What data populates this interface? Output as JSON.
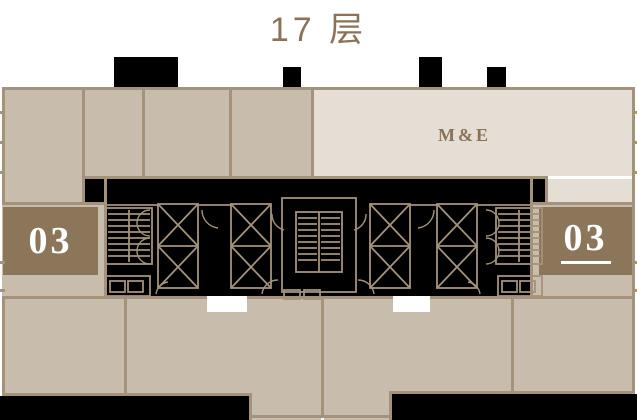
{
  "title": "17 层",
  "floor_plan": {
    "me_room_label": "M&E",
    "units": [
      {
        "id": "unit-03-left",
        "label": "03",
        "selected": false
      },
      {
        "id": "unit-03-right",
        "label": "03",
        "selected": true
      }
    ],
    "icons": [
      "elevator-icon",
      "staircase-icon",
      "door-swing-icon",
      "wc-fixture-icon"
    ],
    "colors": {
      "room_beige": "#c8bdad",
      "me_light": "#e4ded4",
      "wall_tan": "#a4927a",
      "unit_brown": "#8b765a",
      "core_black": "#000000",
      "text_brown": "#8b7257",
      "unit_text_white": "#ffffff"
    }
  }
}
